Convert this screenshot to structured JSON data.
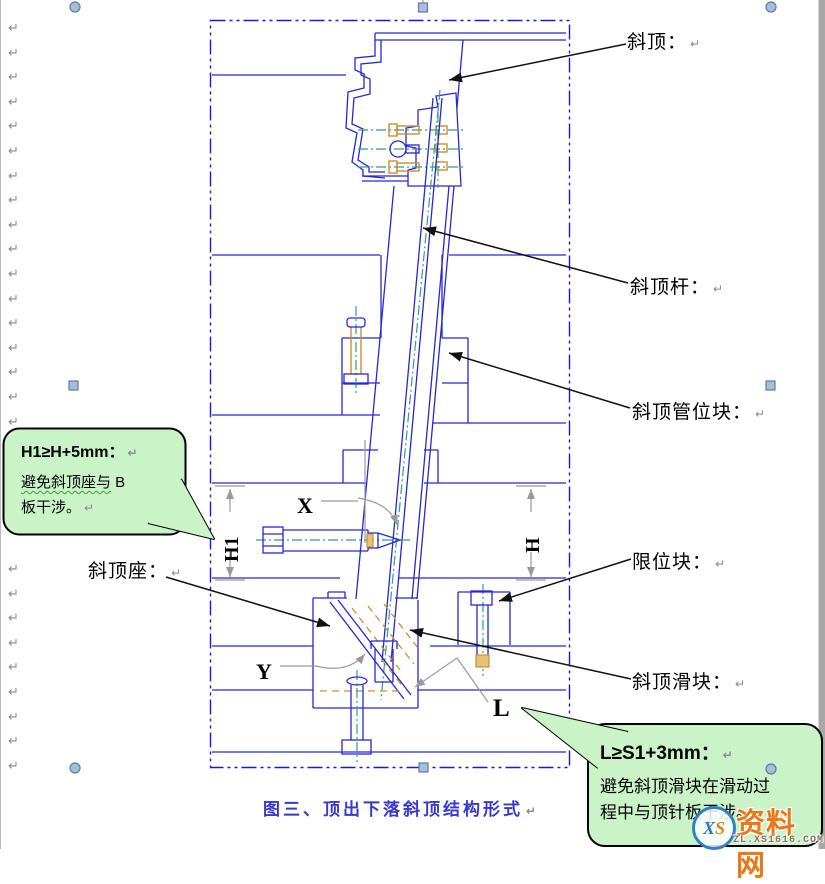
{
  "margin_marks": {
    "glyph": "↵",
    "top_group": {
      "x": 8,
      "start_y": 22,
      "step": 24.6,
      "count": 17
    },
    "bottom_group": {
      "x": 8,
      "start_y": 563,
      "step": 24.6,
      "count": 9
    }
  },
  "labels": {
    "lifter": "斜顶：",
    "lifter_rod": "斜顶杆：",
    "guide_block": "斜顶管位块：",
    "limit_block": "限位块：",
    "lifter_slider": "斜顶滑块：",
    "lifter_seat": "斜顶座："
  },
  "dims": {
    "h1": "H1",
    "h": "H",
    "x": "X",
    "y": "Y",
    "l": "L"
  },
  "bubbles": {
    "left": {
      "title": "H1≥H+5mm：",
      "line1_wavy": "避免斜顶座与",
      "line1_tail": " B",
      "line2": "板干涉。",
      "fill": "#caf3c8"
    },
    "bottom": {
      "title": "L≥S1+3mm：",
      "line1": "避免斜顶滑块在滑动过",
      "line2": "程中与顶针板干涉。",
      "fill": "#caf3c8"
    }
  },
  "caption": {
    "text": "图三、顶出下落斜顶结构形式",
    "color": "#3838d0"
  },
  "watermark": {
    "name": "资料网",
    "domain": "ZL.XS1616.COM",
    "logo_x": "X",
    "logo_s": "S",
    "name_color": "#e87818",
    "logo_x_color": "#2878c8",
    "logo_s_color": "#e08020"
  },
  "colors": {
    "cad_blue": "#2526d9",
    "frame_blue": "#1717e6",
    "centerline_teal": "#2f9e8a",
    "screw_orange": "#c8922f",
    "dim_gray": "#9a9a9a",
    "leader_black": "#111111",
    "bubble_green": "#caf3c8",
    "handle_fill": "#a9bdd6",
    "handle_stroke": "#5b7ca6"
  }
}
